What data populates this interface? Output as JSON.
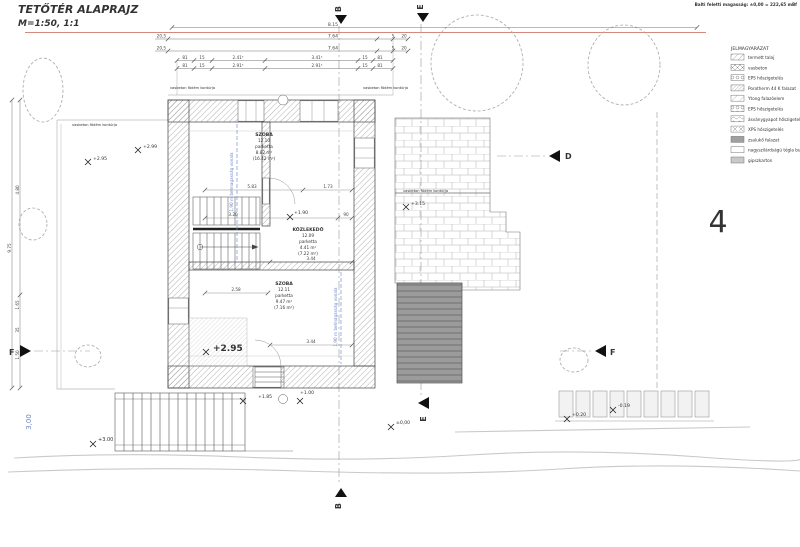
{
  "title": {
    "line1": "TETŐTÉR ALAPRAJZ",
    "line2": "M=1:50, 1:1"
  },
  "note_top_right": "Balti feletti magasság: ±0,00 = 222,65 mBf",
  "sheet_number": "4",
  "legend": {
    "title": "JELMAGYARÁZAT",
    "items": [
      {
        "label": "termett talaj",
        "swatch": "fine-diagonal-hatch"
      },
      {
        "label": "vasbeton",
        "swatch": "cross-hatch"
      },
      {
        "label": "EPS hőszigetelés",
        "swatch": "bubble-hatch"
      },
      {
        "label": "Porotherm 44 K falazat",
        "swatch": "dense-diagonal-hatch"
      },
      {
        "label": "Ytong falazóelem",
        "swatch": "wide-diagonal-hatch"
      },
      {
        "label": "EPS hőszigetelés",
        "swatch": "bubble-hatch"
      },
      {
        "label": "ásványgyapot hőszigetelés",
        "swatch": "wave-hatch"
      },
      {
        "label": "XPS hőszigetelés",
        "swatch": "x-hatch"
      },
      {
        "label": "zsalukő falazat",
        "swatch": "solid-gray"
      },
      {
        "label": "nagyszilárdságú tégla burkolat",
        "swatch": "outline-white"
      },
      {
        "label": "gipszkarton",
        "swatch": "solid-light-gray"
      }
    ]
  },
  "rooms": [
    {
      "name": "SZOBA",
      "number": "12.10",
      "floor": "parketta",
      "area": "8.82 m²",
      "area_total": "(16.42 m²)"
    },
    {
      "name": "KÖZLEKEDŐ",
      "number": "12.09",
      "floor": "parketta",
      "area": "4.41 m²",
      "area_total": "(7.22 m²)"
    },
    {
      "name": "SZOBA",
      "number": "12.11",
      "floor": "parketta",
      "area": "9.47 m²",
      "area_total": "(7.16 m²)"
    }
  ],
  "elevations": [
    "+2.95",
    "+2.99",
    "+1.90",
    "+3.15",
    "+2.95",
    "+1.85",
    "+1.00",
    "±0,00",
    "+0.20",
    "-0.19",
    "+3.00"
  ],
  "annotations": {
    "slab_contour": "vasbeton födém kontúrja",
    "headroom_line": "1,90 m belmagasság vonala",
    "blue_dimension": "3,00"
  },
  "section_markers": {
    "b": "B",
    "e": "E",
    "d": "D",
    "f": "F"
  },
  "dimensions": {
    "total": "8.15",
    "row2": [
      "20,5",
      "7.64",
      "5",
      "20"
    ],
    "row3": [
      "20,5",
      "7.64",
      "5",
      "20"
    ],
    "row4": [
      "81",
      "15",
      "2.41⁵",
      "3.41⁵",
      "15",
      "81"
    ],
    "row5": [
      "81",
      "15",
      "2.91⁵",
      "2.91⁵",
      "15",
      "81"
    ],
    "left": [
      "9.75",
      "4.80",
      "1.65",
      "35",
      "1.50"
    ],
    "inner": [
      "5.83",
      "1.73",
      "3.20",
      "90",
      "3.44",
      "2.58",
      "3.44"
    ]
  }
}
